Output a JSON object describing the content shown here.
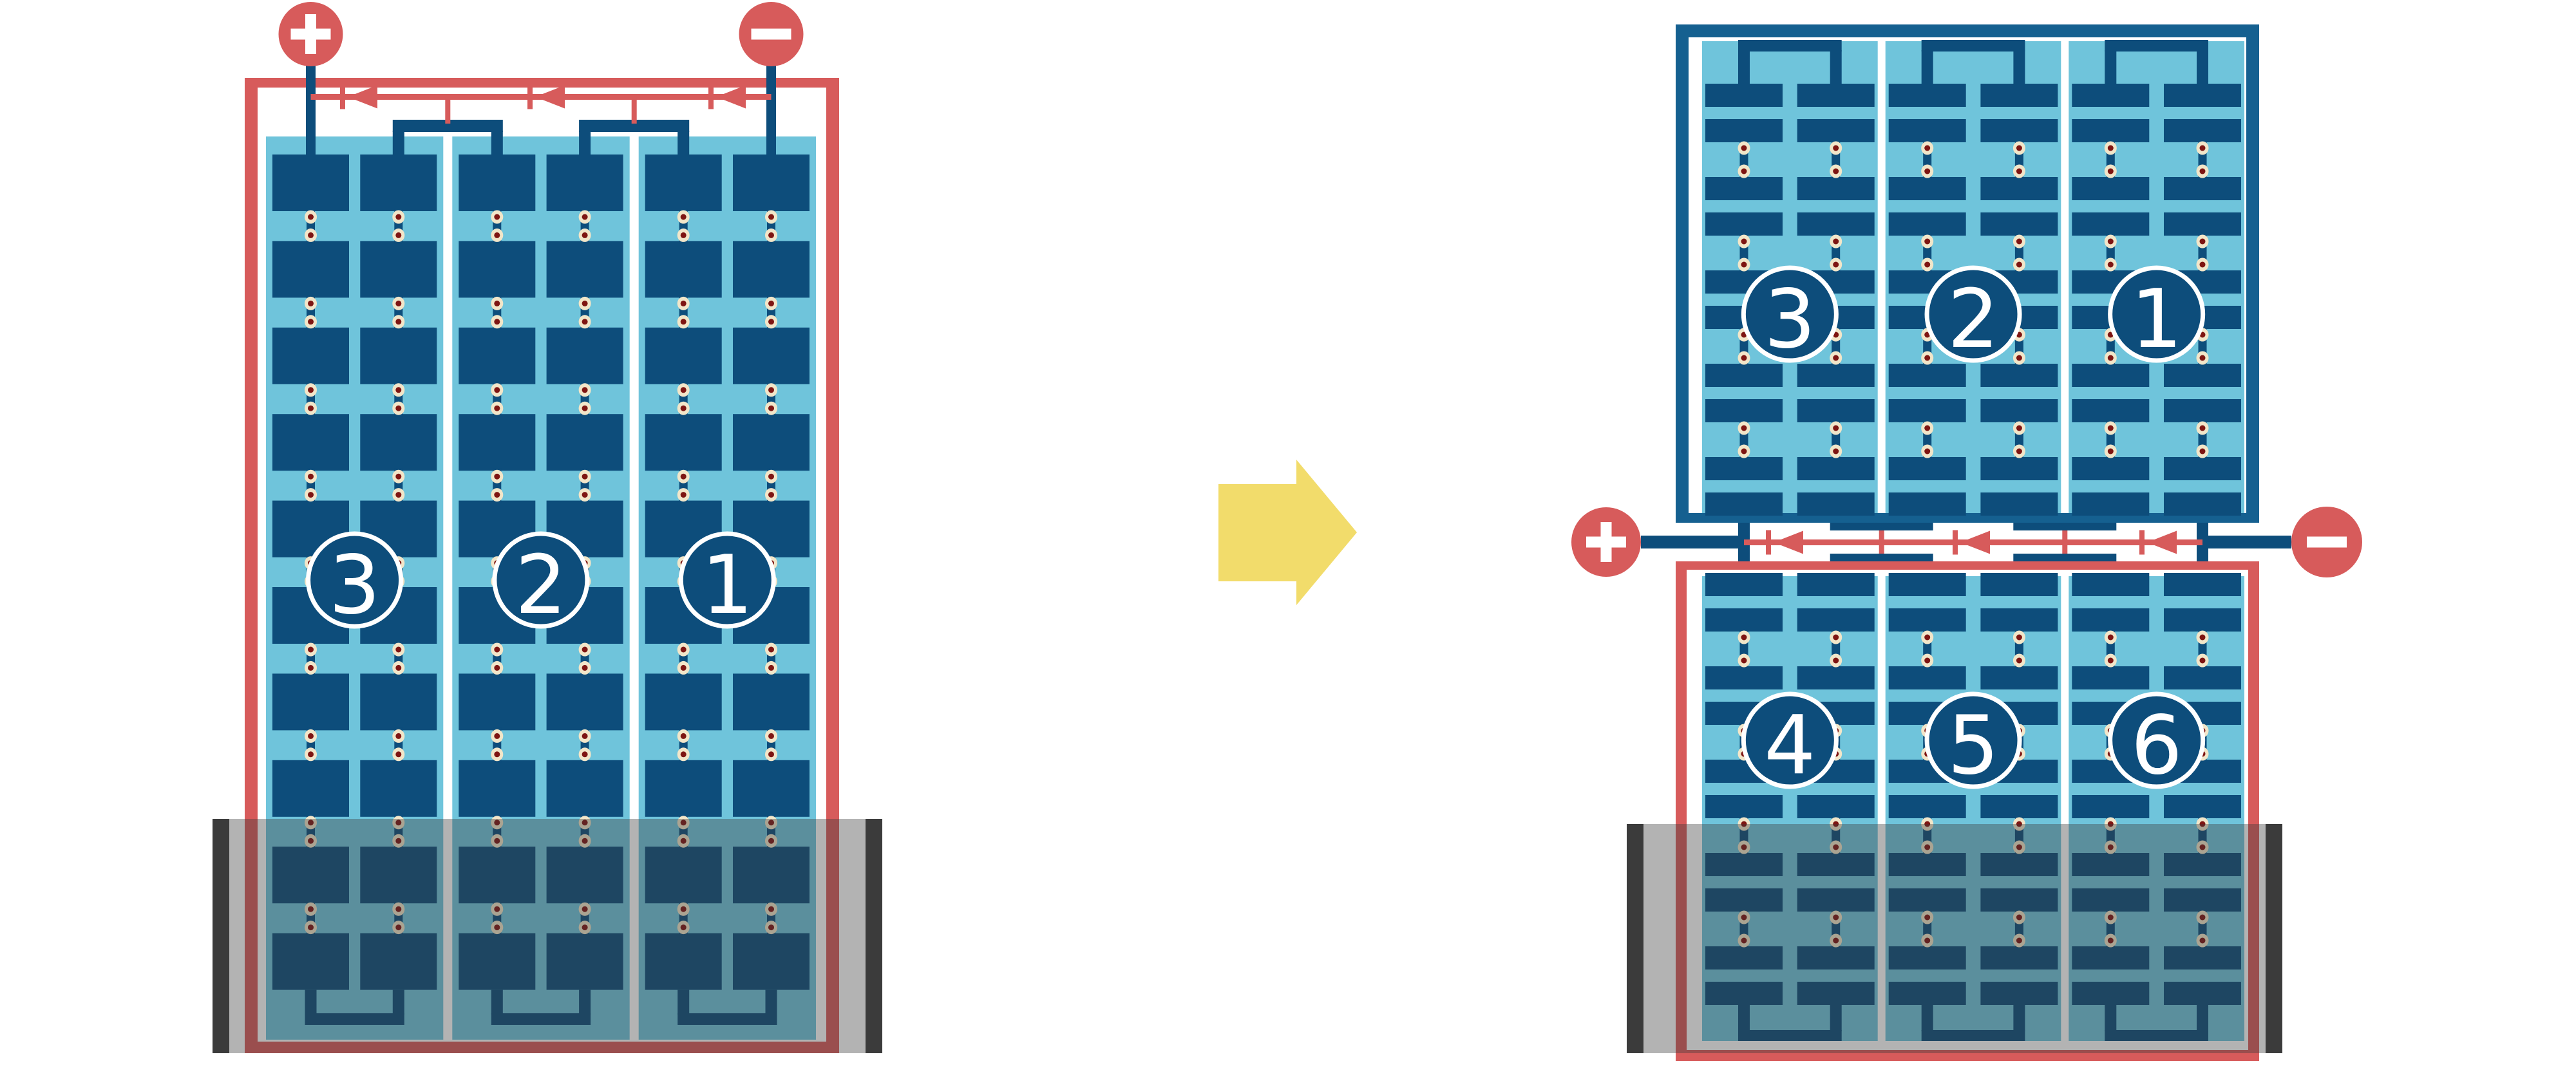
{
  "figure": {
    "kind": "solar-panel-bypass-diode-shading-diagram",
    "arrow_direction": "right"
  },
  "colors": {
    "background": "#FFFFFF",
    "red": "#D75B5B",
    "cell_blue": "#0D4D7B",
    "frame_blue": "#156090",
    "light_blue": "#6FC4DB",
    "cream": "#F2E6C9",
    "dot_red": "#7E1512",
    "shade_overlay": "rgba(58,58,58,0.39)",
    "shade_bar": "#3B3B3B",
    "arrow_yellow": "#F2DC6B",
    "white": "#FFFFFF"
  },
  "left_panel": {
    "terminals": [
      {
        "id": "positive",
        "label": "+"
      },
      {
        "id": "negative",
        "label": "−"
      }
    ],
    "string_labels": [
      "3",
      "2",
      "1"
    ],
    "strings": 3,
    "columns": 6,
    "rows": 10,
    "bypass_diodes": 3,
    "shade_position": "bottom"
  },
  "right_assembly": {
    "top_panel": {
      "string_labels": [
        "3",
        "2",
        "1"
      ],
      "strings": 3,
      "columns": 6,
      "rows": 10
    },
    "junction": {
      "terminals": [
        {
          "id": "positive",
          "label": "+"
        },
        {
          "id": "negative",
          "label": "−"
        }
      ],
      "bypass_diodes": 3
    },
    "bottom_panel": {
      "string_labels": [
        "4",
        "5",
        "6"
      ],
      "strings": 3,
      "columns": 6,
      "rows": 10,
      "shade_position": "bottom"
    }
  }
}
